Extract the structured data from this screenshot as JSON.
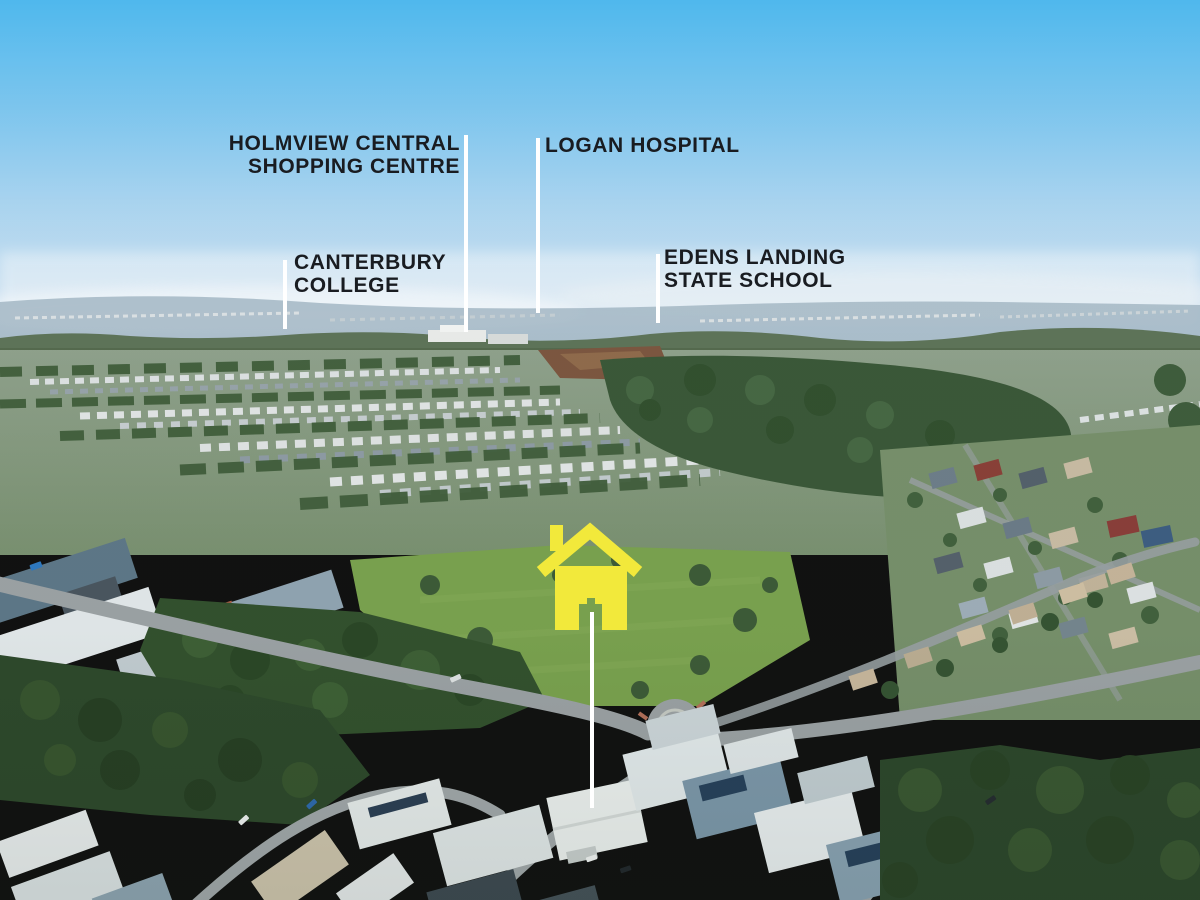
{
  "image": {
    "description": "Aerial drone photograph of a suburban housing estate with labelled nearby landmarks and a yellow house marker on the subject property"
  },
  "annotations": {
    "landmarks": [
      {
        "name": "holmview-central-shopping-centre",
        "lines": [
          "HOLMVIEW CENTRAL",
          "SHOPPING CENTRE"
        ]
      },
      {
        "name": "logan-hospital",
        "lines": [
          "LOGAN HOSPITAL"
        ]
      },
      {
        "name": "canterbury-college",
        "lines": [
          "CANTERBURY",
          "COLLEGE"
        ]
      },
      {
        "name": "edens-landing-state-school",
        "lines": [
          "EDENS LANDING",
          "STATE SCHOOL"
        ]
      }
    ],
    "marker": {
      "name": "subject-property-house-marker",
      "color": "#F2E93B"
    },
    "leader_line_color": "#FFFFFF",
    "label_text_color": "#191C21"
  },
  "palette": {
    "sky_top": "#4FB8ED",
    "sky_horizon": "#D9E7F2",
    "forest_green": "#33512E",
    "grass_green": "#7AA24F",
    "road_grey": "#9CA2A5"
  }
}
